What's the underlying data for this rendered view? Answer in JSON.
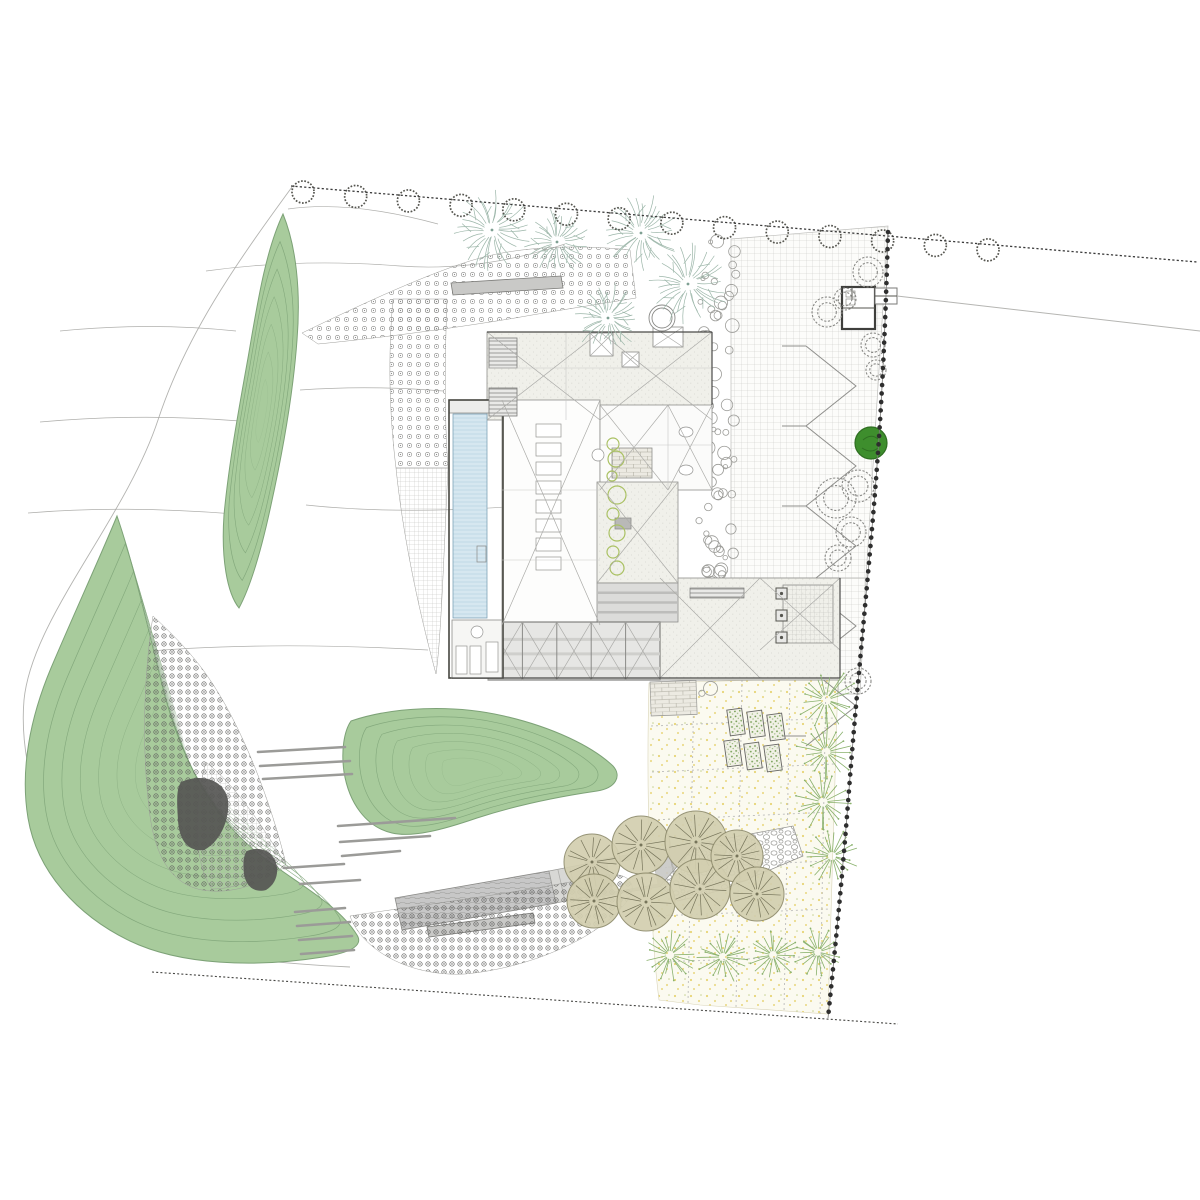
{
  "document": {
    "type": "architectural-site-plan",
    "description": "Residential site plan with house roof plan, linear pool, gridded courtyard, green landscape mounds, orchard meadow and entry drive",
    "visible_text": []
  },
  "colors": {
    "green": "#a8cb9c",
    "green-edge": "#7da277",
    "teal": "#9cb6a9",
    "olive-fill": "#d3cfb0",
    "olive-edge": "#8f8c6d",
    "olive-line": "#76745a",
    "orchard": "#89b16c",
    "dark-tree": "#3e8e2d",
    "dark-tree-edge": "#2f6e22",
    "wall": "#c9c9c7",
    "ink": "#3a3a3a",
    "grid-line": "#c9c9c5",
    "grid-fine": "#b9b9b5",
    "stipple-bg": "#f0f0ea",
    "stipple-dot": "#d9d9d2",
    "pool": "#d6e7f0",
    "pool-line": "#b7d3e2",
    "ydot": "#e4ce62",
    "flower": "#5f5f5d",
    "flowerlight": "#8c8c8a",
    "pebble": "#9a9a96",
    "bead": "#2e2e2e",
    "contour": "#a6a6a3",
    "asphalt": "#c7c7c7",
    "meadow": "#fbfaf0"
  },
  "site": {
    "west_edge": "M292,187 C235,265 186,335 158,420 C125,520 32,618 24,700 C17,782 60,878 112,920 C152,950 258,963 350,967",
    "contours": [
      "M288,209 Q350,200 438,224",
      "M206,271 Q300,258 400,266 Q480,272 565,244",
      "M60,331 Q150,322 236,331",
      "M300,390 Q370,385 443,391",
      "M40,422 Q140,413 240,421",
      "M28,513 Q120,505 235,514",
      "M306,505 Q400,515 520,506 Q600,500 660,508",
      "M118,654 Q250,640 428,650"
    ],
    "mounds": [
      {
        "path": "M283,214 C296,246 301,290 297,340 C293,395 282,455 271,505 C262,547 252,584 239,608 C227,593 221,558 224,515 C229,462 239,408 248,358 C257,306 265,252 283,214 Z",
        "cx": 262,
        "cy": 411,
        "rings": 6,
        "step": 0.14
      },
      {
        "path": "M117,516 C101,555 77,607 51,668 C30,718 20,770 28,818 C37,872 78,916 130,941 C180,965 255,968 323,957 C349,953 364,946 357,935 C337,903 297,884 259,854 C212,817 183,760 166,700 C152,646 135,568 117,516 Z",
        "cx": 192,
        "cy": 768,
        "rings": 7,
        "step": 0.11
      },
      {
        "path": "M351,721 C392,707 452,704 504,716 C552,727 592,746 613,766 C622,776 616,788 597,791 C556,797 514,806 477,818 C445,829 413,838 392,833 C366,827 349,803 344,772 C341,751 344,731 351,721 Z",
        "cx": 470,
        "cy": 772,
        "rings": 6,
        "step": 0.13
      }
    ],
    "hatches": [
      {
        "path": "M302,333 C360,305 430,272 480,258 C520,247 575,244 630,250 L636,298 C600,304 560,310 515,318 C455,328 380,338 318,344 Z",
        "pattern": "flowerLight"
      },
      {
        "path": "M393,299 C388,355 389,412 396,468 L448,468 C444,412 445,355 447,299 Z",
        "pattern": "flowerLight"
      },
      {
        "path": "M396,468 C402,528 416,600 436,674 C441,640 444,550 448,468 Z",
        "pattern": "gridFine"
      },
      {
        "path": "M153,616 C144,672 141,748 150,816 C156,858 172,884 202,890 C232,895 264,884 286,864 C272,806 243,726 206,674 C189,650 168,630 153,616 Z",
        "pattern": "flower"
      },
      {
        "path": "M206,762 C238,788 262,826 283,860 C265,877 237,889 212,889 C196,868 191,814 206,762 Z",
        "pattern": "gridFine"
      }
    ],
    "dark_patches": [
      "M181,782 C205,772 225,782 228,800 C230,820 220,842 204,850 C188,852 179,840 178,820 C177,802 176,790 181,782 Z",
      "M247,851 C259,846 270,850 275,860 C280,872 276,884 266,890 C255,893 246,887 244,874 C243,864 243,856 247,851 Z"
    ],
    "walls": [
      "M451,283 L561,276 L563,288 L453,295 Z",
      "M427,927 L533,913 L535,923 L429,937 Z"
    ],
    "timber_dashes": [
      [
        258,
        752,
        345,
        747
      ],
      [
        260,
        766,
        350,
        761
      ],
      [
        263,
        779,
        352,
        774
      ],
      [
        338,
        826,
        455,
        818
      ],
      [
        340,
        842,
        430,
        836
      ],
      [
        342,
        856,
        400,
        851
      ],
      [
        284,
        868,
        344,
        864
      ],
      [
        300,
        884,
        360,
        880
      ],
      [
        295,
        912,
        345,
        908
      ],
      [
        297,
        926,
        350,
        922
      ],
      [
        299,
        940,
        352,
        936
      ],
      [
        301,
        954,
        354,
        950
      ]
    ],
    "meadow": {
      "path": "M649,683 L838,678 L828,1014 L700,1005 L659,1000 C650,930 646,790 649,683 Z",
      "grid_h": [
        [
          651,
          726,
          835,
          718
        ],
        [
          652,
          772,
          834,
          764
        ],
        [
          653,
          820,
          832,
          812
        ],
        [
          655,
          868,
          831,
          861
        ],
        [
          656,
          916,
          830,
          909
        ],
        [
          658,
          962,
          829,
          956
        ]
      ],
      "grid_v": [
        [
          694,
          681,
          688,
          1003
        ],
        [
          742,
          680,
          736,
          1008
        ],
        [
          790,
          678,
          784,
          1012
        ],
        [
          826,
          677,
          820,
          1014
        ]
      ],
      "beds": [
        [
          736,
          722
        ],
        [
          756,
          724
        ],
        [
          776,
          727
        ],
        [
          733,
          753
        ],
        [
          753,
          756
        ],
        [
          773,
          758
        ]
      ],
      "bed_w": 15,
      "bed_h": 26,
      "bed_rot": -8,
      "brick": {
        "x": 650,
        "y": 682,
        "w": 46,
        "h": 34
      }
    },
    "courtyard": {
      "polys": [
        "M731,239 L888,226 L866,578 L731,578 Z",
        "M840,578 L866,578 L860,694 L838,694 Z"
      ],
      "zigzag": {
        "x1": 806,
        "x2": 856,
        "ytop": 346,
        "dy": 40,
        "legs": 10
      },
      "ticks": [
        346,
        426,
        506,
        586,
        666,
        736
      ]
    },
    "bubbles": {
      "x": 699,
      "y": 240,
      "w": 37,
      "h": 455,
      "n": 85,
      "seed": 7
    },
    "driveway": {
      "asphalt": "M395,898 L549,871 L556,903 L402,930 Z",
      "stripes": "M549,871 L585,864 L592,896 L556,903 Z",
      "stripe_lines": [
        [
          558,
          870,
          565,
          901
        ],
        [
          570,
          868,
          577,
          899
        ],
        [
          581,
          866,
          588,
          897
        ]
      ],
      "pads": [
        "M585,862 L668,848 L676,884 L593,898 Z",
        "M668,848 L700,842 L707,872 L676,878 Z"
      ],
      "pad_inner": "M607,864 L652,856 L658,884 L613,892 Z",
      "pebble": "M660,886 L697,844 L793,826 L803,856 L722,890 L678,901 Z",
      "crescent": "M350,916 C420,905 520,893 600,876 C625,870 640,882 628,900 C600,938 530,968 465,974 C410,977 362,950 350,916 Z"
    },
    "building": {
      "north": {
        "x": 487,
        "y": 332,
        "w": 225,
        "h": 88
      },
      "hall": {
        "x": 502,
        "y": 400,
        "w": 98,
        "h": 225
      },
      "core": {
        "x": 600,
        "y": 405,
        "w": 112,
        "h": 85
      },
      "central_roof": {
        "x": 597,
        "y": 482,
        "w": 81,
        "h": 101
      },
      "chimney": {
        "x": 615,
        "y": 518,
        "w": 16,
        "h": 11
      },
      "se_wing": {
        "x": 660,
        "y": 578,
        "w": 180,
        "h": 102
      },
      "grid_patch": {
        "x": 783,
        "y": 585,
        "w": 50,
        "h": 58
      },
      "skylight": {
        "x": 597,
        "y": 583,
        "w": 81,
        "h": 39
      },
      "glazing": {
        "x": 488,
        "y": 622,
        "w": 172,
        "h": 58,
        "panels": 5
      },
      "pool_frame": {
        "x": 449,
        "y": 400,
        "w": 54,
        "h": 278
      },
      "pool": {
        "x": 453,
        "y": 414,
        "w": 34,
        "h": 204
      },
      "canopy": {
        "x": 449,
        "y": 400,
        "w": 54,
        "h": 13
      },
      "terrace": {
        "x": 452,
        "y": 620,
        "w": 50,
        "h": 58
      },
      "loungers": [
        [
          456,
          646,
          11,
          28
        ],
        [
          470,
          646,
          11,
          28
        ],
        [
          486,
          642,
          12,
          30
        ]
      ],
      "table": [
        477,
        632,
        6
      ],
      "ladder": {
        "x": 477,
        "y": 546,
        "w": 9,
        "h": 16
      },
      "brick_patch": {
        "x": 612,
        "y": 448,
        "w": 40,
        "h": 30
      },
      "fixtures": [
        [
          686,
          432
        ],
        [
          686,
          470
        ]
      ],
      "sink": [
        598,
        455,
        6
      ],
      "louvers": [
        [
          489,
          338,
          28,
          30
        ],
        [
          489,
          388,
          28,
          28
        ]
      ],
      "louver_bar": {
        "x": 690,
        "y": 588,
        "w": 54,
        "h": 10
      },
      "xboxes": [
        [
          590,
          333,
          23,
          23
        ],
        [
          622,
          352,
          17,
          15
        ],
        [
          653,
          327,
          30,
          20
        ]
      ],
      "skyboxes": [
        [
          776,
          588,
          11,
          11
        ],
        [
          776,
          610,
          11,
          11
        ],
        [
          776,
          632,
          11,
          11
        ]
      ],
      "counters": {
        "x": 536,
        "y0": 424,
        "w": 25,
        "h": 13,
        "step": 19,
        "n": 8
      },
      "plants": [
        [
          613,
          444,
          6
        ],
        [
          616,
          459,
          8
        ],
        [
          612,
          476,
          5
        ],
        [
          617,
          495,
          9
        ],
        [
          613,
          514,
          6
        ],
        [
          617,
          533,
          8
        ],
        [
          613,
          552,
          6
        ],
        [
          617,
          568,
          7
        ]
      ],
      "ilines": [
        [
          487,
          368,
          712,
          368
        ],
        [
          566,
          332,
          566,
          420
        ],
        [
          502,
          490,
          600,
          490
        ],
        [
          600,
          445,
          712,
          445
        ],
        [
          668,
          405,
          668,
          490
        ],
        [
          502,
          560,
          600,
          560
        ]
      ],
      "xlines": [
        [
          487,
          332,
          600,
          420
        ],
        [
          600,
          332,
          487,
          420
        ],
        [
          600,
          332,
          712,
          420
        ],
        [
          712,
          332,
          600,
          420
        ],
        [
          502,
          400,
          600,
          625
        ],
        [
          600,
          400,
          502,
          625
        ],
        [
          597,
          482,
          678,
          583
        ],
        [
          678,
          482,
          597,
          583
        ],
        [
          660,
          578,
          760,
          678
        ],
        [
          760,
          578,
          660,
          678
        ],
        [
          760,
          578,
          840,
          650
        ],
        [
          840,
          578,
          760,
          650
        ],
        [
          600,
          405,
          668,
          490
        ],
        [
          668,
          405,
          600,
          490
        ],
        [
          668,
          405,
          712,
          490
        ],
        [
          712,
          405,
          668,
          490
        ]
      ],
      "dedges": [
        [
          452,
          678,
          840,
          678
        ],
        [
          487,
          332,
          712,
          332
        ],
        [
          712,
          332,
          712,
          405
        ],
        [
          840,
          578,
          840,
          678
        ]
      ],
      "ring_planter": [
        662,
        318,
        13,
        10
      ]
    },
    "garage": {
      "outer": {
        "x": 842,
        "y": 287,
        "w": 33,
        "h": 42
      },
      "annex": {
        "x": 875,
        "y": 288,
        "w": 22,
        "h": 16
      },
      "lines": [
        [
          843,
          308,
          875,
          308
        ],
        [
          852,
          287,
          852,
          300
        ],
        [
          875,
          296,
          897,
          296
        ]
      ],
      "doors": [
        [
          846,
          291,
          9,
          6
        ],
        [
          846,
          299,
          9,
          6
        ]
      ]
    },
    "fence": "M897,296 L1200,331",
    "boundaries": {
      "north": "M291,186 L1197,262",
      "east": "M888,232 C884,380 878,460 871,540 C864,620 856,700 849,790 C843,870 835,950 828,1018",
      "south": "M152,972 L898,1024"
    },
    "scallop_row": {
      "x1": 303,
      "x2": 988,
      "n": 14,
      "r": 11
    },
    "trees": {
      "teal": [
        [
          492,
          230,
          41
        ],
        [
          557,
          242,
          33
        ],
        [
          641,
          233,
          39
        ],
        [
          688,
          284,
          41
        ],
        [
          608,
          318,
          35
        ]
      ],
      "olive": [
        [
          592,
          862,
          28
        ],
        [
          641,
          845,
          29
        ],
        [
          696,
          842,
          31
        ],
        [
          594,
          901,
          27
        ],
        [
          646,
          902,
          29
        ],
        [
          700,
          889,
          30
        ],
        [
          737,
          856,
          26
        ],
        [
          757,
          894,
          27
        ]
      ],
      "orchard": [
        [
          826,
          700,
          33
        ],
        [
          826,
          752,
          30
        ],
        [
          823,
          802,
          30
        ],
        [
          832,
          856,
          27
        ],
        [
          670,
          955,
          27
        ],
        [
          723,
          957,
          27
        ],
        [
          773,
          955,
          26
        ],
        [
          818,
          952,
          25
        ]
      ],
      "rings": [
        [
          873,
          345,
          12
        ],
        [
          876,
          370,
          10
        ],
        [
          836,
          498,
          20
        ],
        [
          858,
          486,
          16
        ],
        [
          851,
          532,
          15
        ],
        [
          838,
          558,
          13
        ],
        [
          868,
          272,
          15
        ],
        [
          827,
          312,
          15
        ],
        [
          845,
          299,
          11
        ],
        [
          858,
          681,
          13
        ]
      ],
      "dark": [
        871,
        443,
        16
      ]
    }
  }
}
